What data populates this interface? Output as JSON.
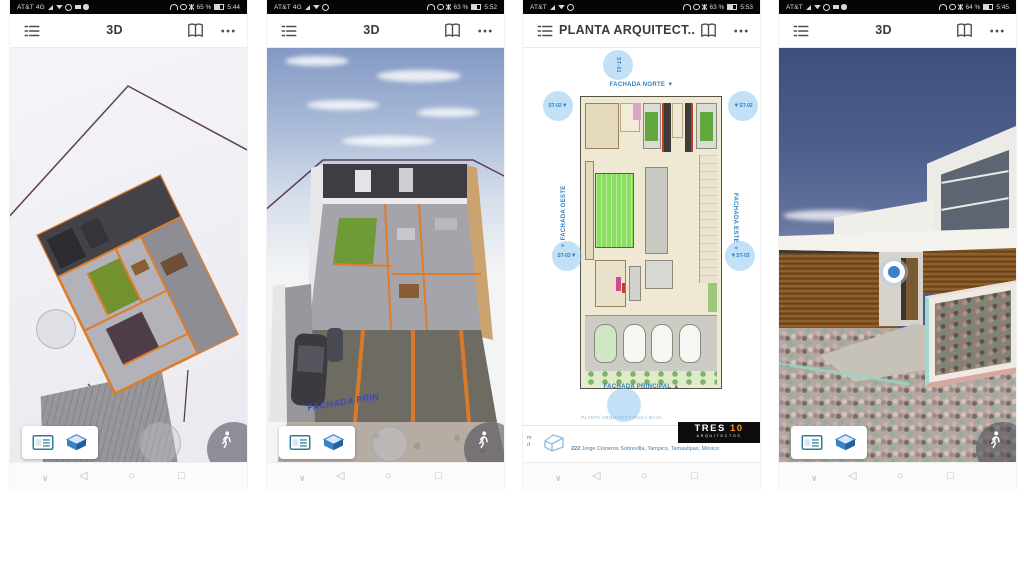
{
  "ui": {
    "nav": {
      "chevron": "∨",
      "back": "◁",
      "home": "○",
      "recents": "□"
    },
    "arrow_down": "▼",
    "arrow_up": "▲"
  },
  "screens": [
    {
      "id": 1,
      "title": "3D",
      "status": {
        "carrier": "AT&T 4G",
        "battery": "65 %",
        "time": "5:44"
      }
    },
    {
      "id": 2,
      "title": "3D",
      "status": {
        "carrier": "AT&T 4G",
        "battery": "63 %",
        "time": "5:52"
      },
      "scene": {
        "ground_label": "FACHADA PRIN"
      }
    },
    {
      "id": 3,
      "title": "PLANTA ARQUITECT...",
      "status": {
        "carrier": "AT&T",
        "battery": "63 %",
        "time": "5:53"
      },
      "plan": {
        "north": "FACHADA NORTE",
        "west": "FACHADA OESTE",
        "east": "FACHADA ESTE",
        "principal": "FACHADA PRINCIPAL",
        "marker_top": "ST-01",
        "marker_upper": "ST-02",
        "marker_lower": "ST-03",
        "caption": "PLANTA ARQUITECTONICA BAJA"
      },
      "footer": {
        "edge_line1": "m",
        "edge_line2": "d",
        "address_number": "222",
        "address": "Jorge Cisneros Sobrevilla, Tampico, Tamaulipas, México",
        "logo_name": "TRES",
        "logo_number": "10",
        "logo_subtitle": "ARQUITECTOS"
      }
    },
    {
      "id": 4,
      "title": "3D",
      "status": {
        "carrier": "AT&T",
        "battery": "64 %",
        "time": "5:45"
      }
    }
  ],
  "colors": {
    "wall_orange": "#e07b28",
    "boundary_purple": "#5e3d57",
    "marker_blue": "#2f7fc1",
    "logo_orange": "#f59a23",
    "sky_navy": "#3f4f7c"
  }
}
